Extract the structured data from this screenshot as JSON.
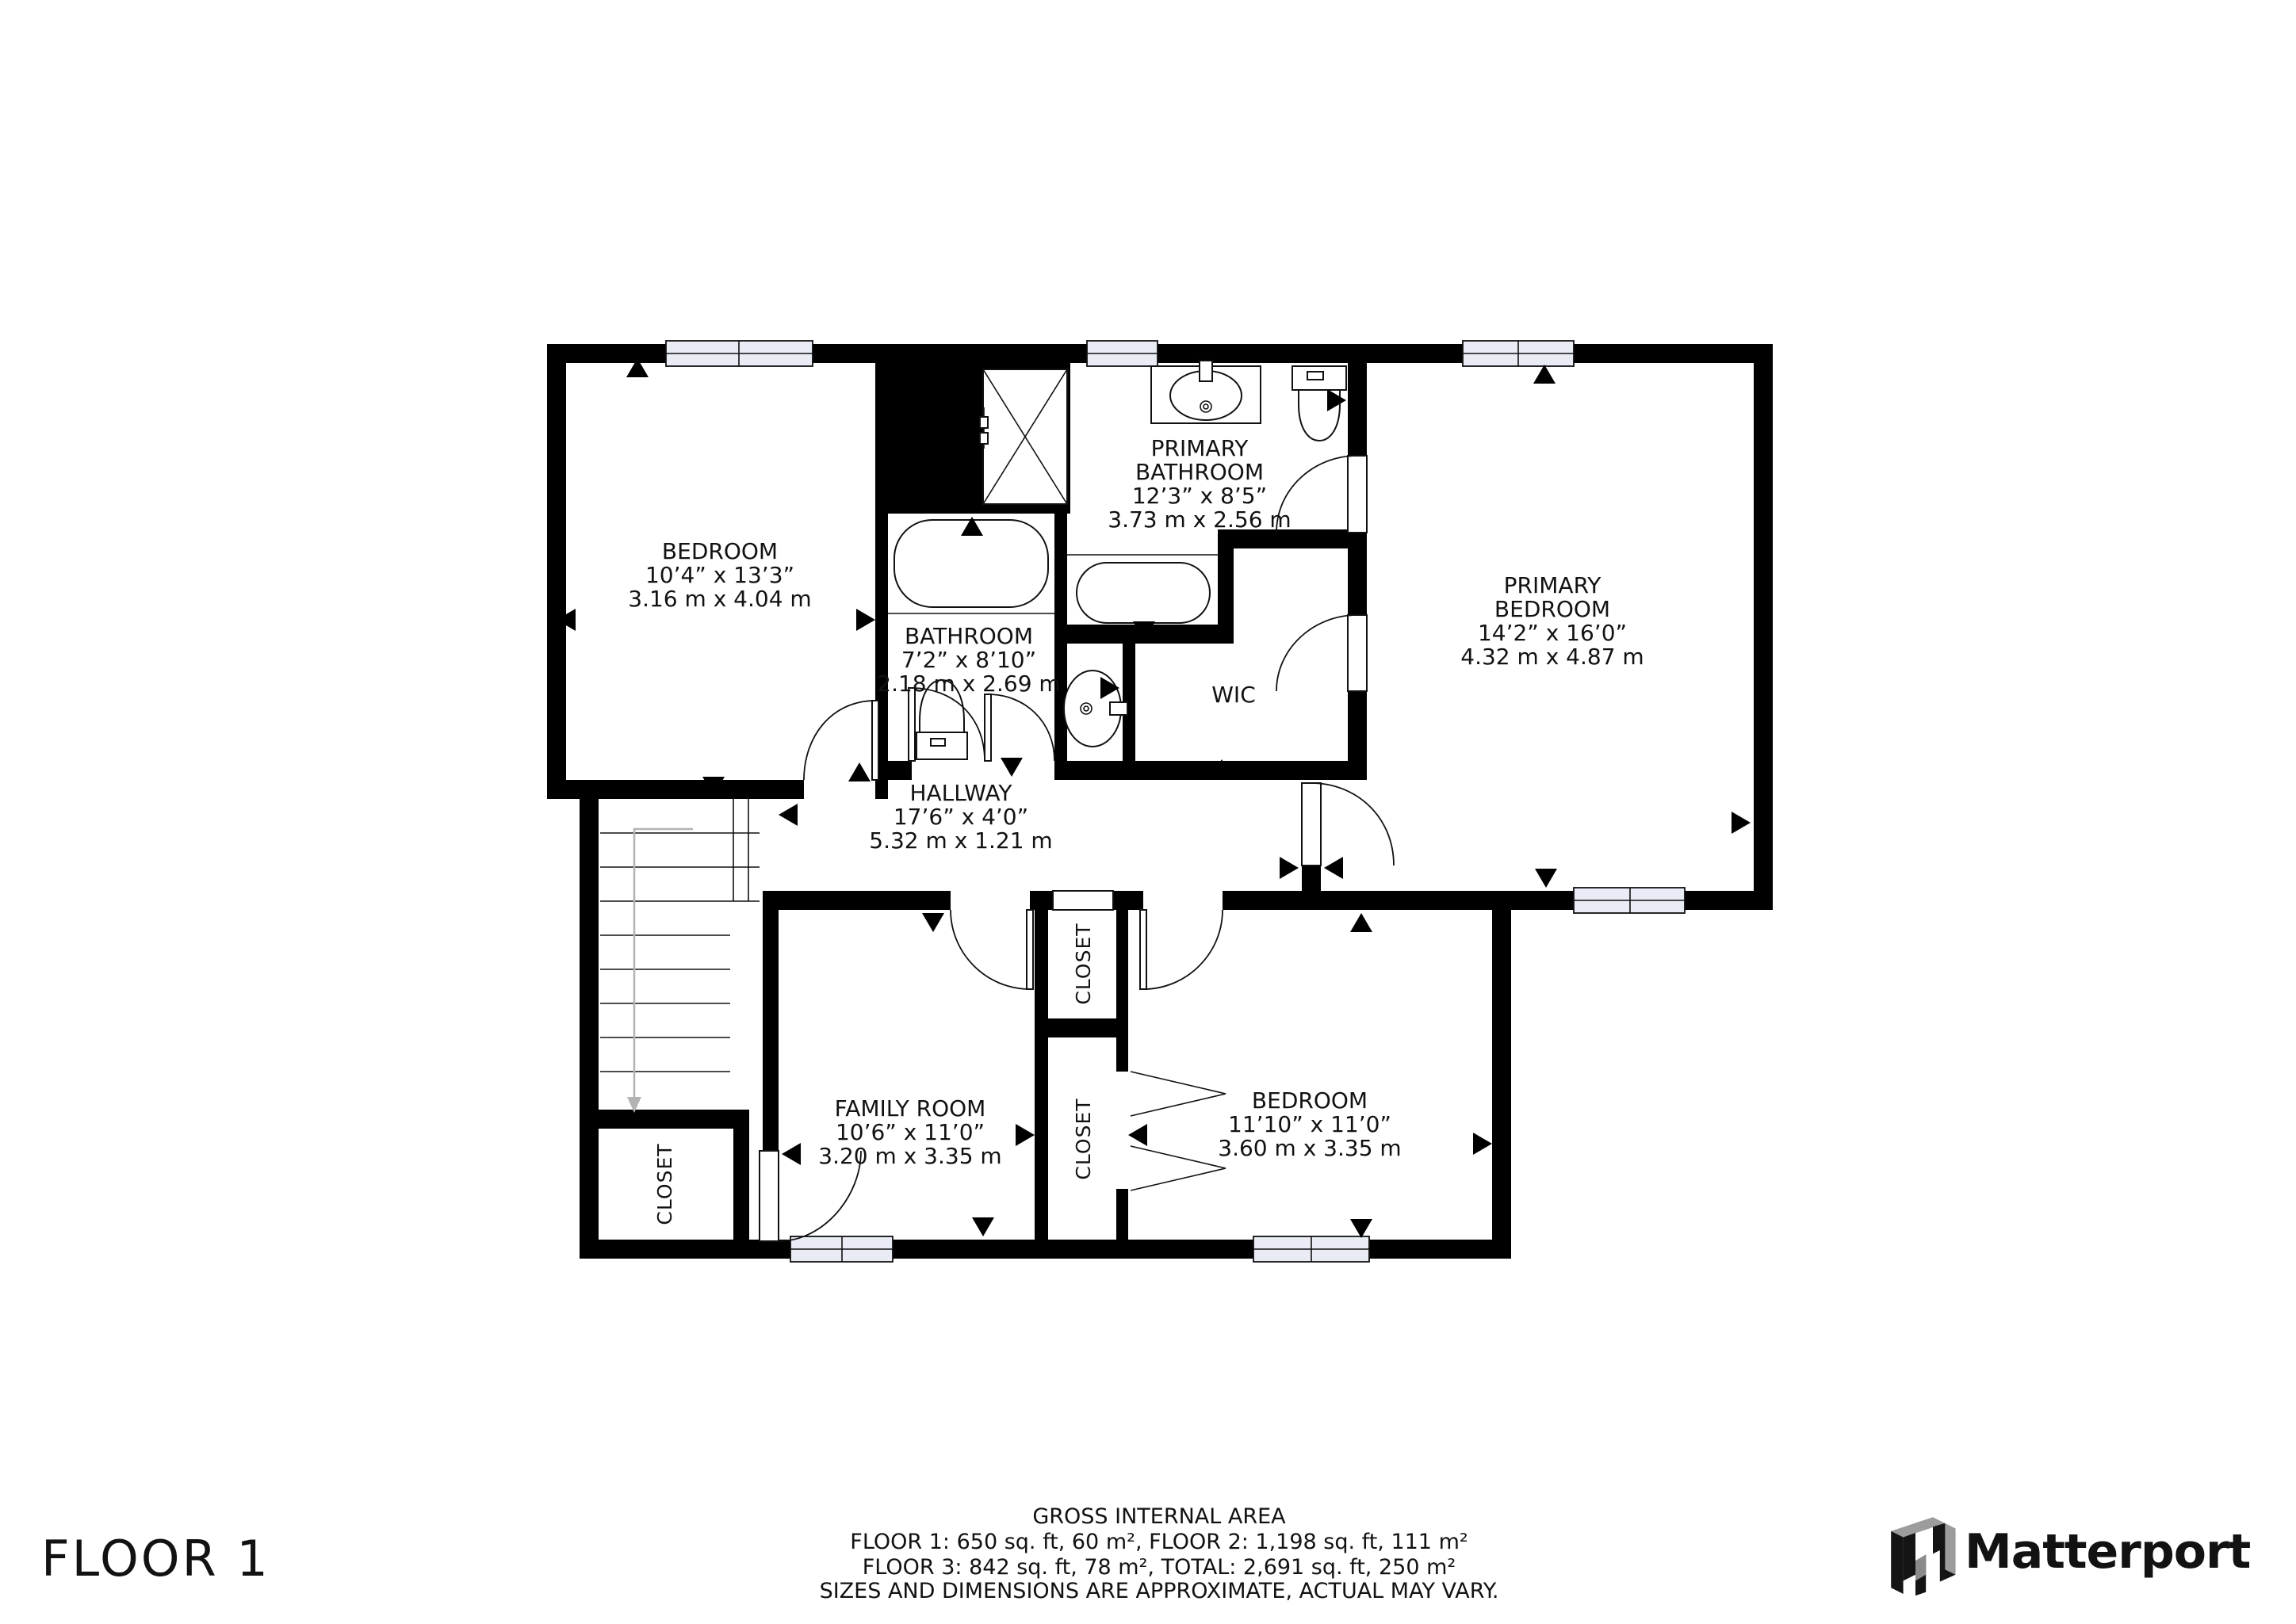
{
  "rooms": {
    "bedroom_tl": {
      "lines": [
        "BEDROOM",
        "10’4” x 13’3”",
        "3.16 m x 4.04 m"
      ]
    },
    "primary_bathroom": {
      "lines": [
        "PRIMARY",
        "BATHROOM",
        "12’3” x 8’5”",
        "3.73 m x 2.56 m"
      ]
    },
    "bathroom": {
      "lines": [
        "BATHROOM",
        "7’2” x 8’10”",
        "2.18 m x 2.69 m"
      ]
    },
    "primary_bedroom": {
      "lines": [
        "PRIMARY",
        "BEDROOM",
        "14’2” x 16’0”",
        "4.32 m x 4.87 m"
      ]
    },
    "wic": {
      "label": "WIC"
    },
    "hallway": {
      "lines": [
        "HALLWAY",
        "17’6” x 4’0”",
        "5.32 m x 1.21 m"
      ]
    },
    "family_room": {
      "lines": [
        "FAMILY ROOM",
        "10’6” x 11’0”",
        "3.20 m x 3.35 m"
      ]
    },
    "bedroom_br": {
      "lines": [
        "BEDROOM",
        "11’10” x 11’0”",
        "3.60 m x 3.35 m"
      ]
    },
    "closet_hall": {
      "label": "CLOSET"
    },
    "closet_bedroom": {
      "label": "CLOSET"
    },
    "closet_stairs": {
      "label": "CLOSET"
    }
  },
  "footer": {
    "area_title": "GROSS INTERNAL AREA",
    "area_line1": "FLOOR 1: 650 sq. ft, 60 m², FLOOR 2: 1,198 sq. ft, 111 m²",
    "area_line2": "FLOOR 3: 842 sq. ft, 78 m², TOTAL: 2,691 sq. ft, 250 m²",
    "disclaimer": "SIZES AND DIMENSIONS ARE APPROXIMATE, ACTUAL MAY VARY.",
    "floor_label": "FLOOR 1",
    "brand": "Matterport"
  },
  "colors": {
    "wall": "#000000",
    "window_fill": "#e9ebf5",
    "floor_label_gray": "#a7a7a7",
    "disclaimer_gray": "#9b9b9b",
    "brand_dark": "#202020",
    "brand_gray": "#979797",
    "stair_arrow": "#b3b3b3"
  }
}
